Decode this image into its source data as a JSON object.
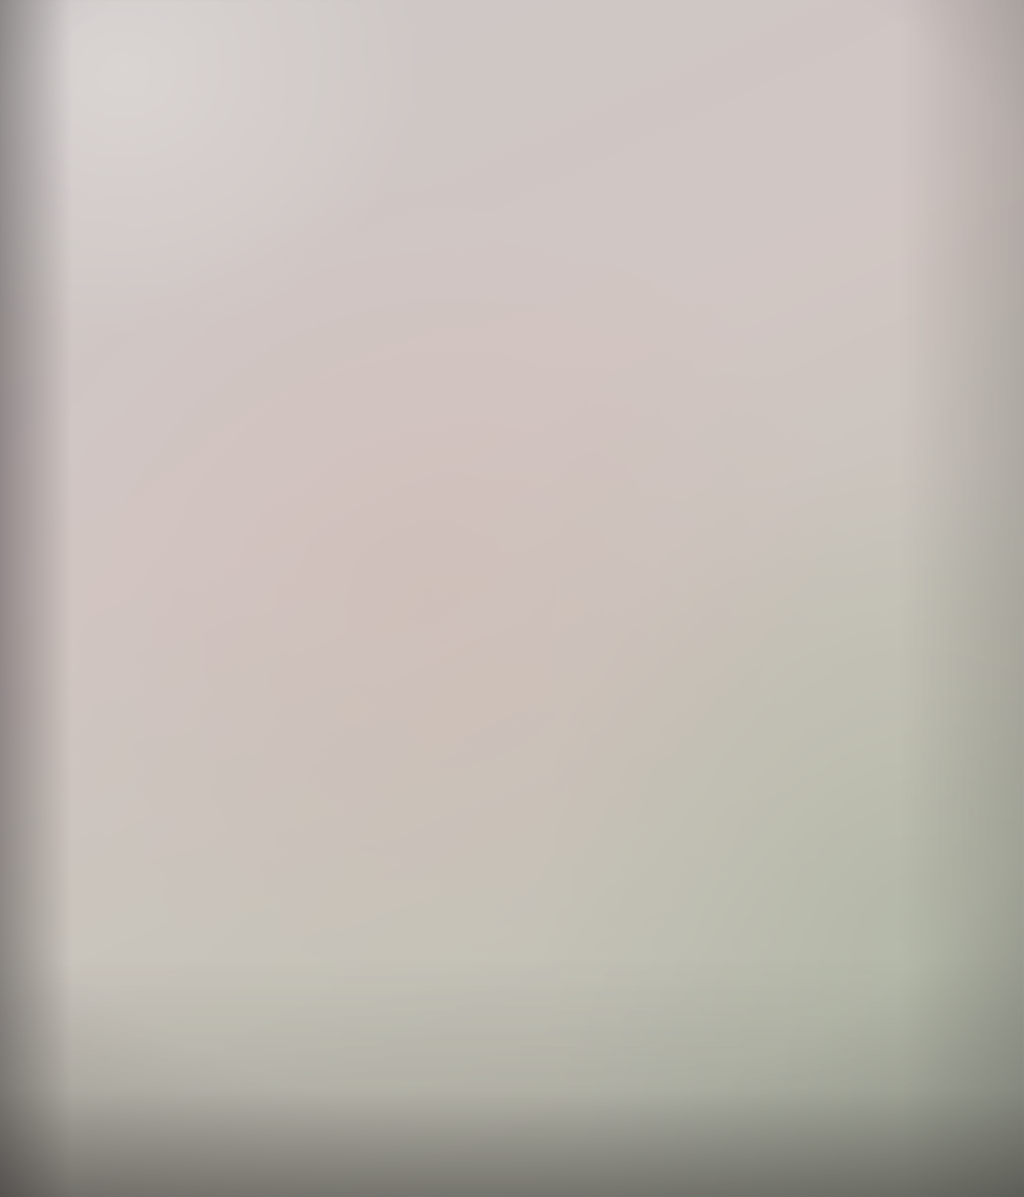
{
  "watermark": {
    "icon": "swan-swirl-icon",
    "name_cn": "锦明地产",
    "name_en": "Jinming Real Estate",
    "color": "#ffffff"
  },
  "branding": {
    "site_cn": "房天下",
    "site_en": "Fang.com",
    "color": "#ffffff"
  },
  "plan": {
    "ink_color": "#3a3336",
    "paper_color": "#cfc7c3",
    "units": [
      {
        "no": "15",
        "area": "114.82"
      },
      {
        "no": "12",
        "area": "104.13"
      },
      {
        "no": "16",
        "area": "121.42"
      },
      {
        "no": "11",
        "area": "126.08"
      },
      {
        "no": "10",
        "area": "144.86"
      },
      {
        "no": "09",
        "area": "107.98"
      },
      {
        "no": "08",
        "area": "107.07"
      },
      {
        "no": "17",
        "area": "276.52"
      },
      {
        "no": "18",
        "area": "132.98"
      },
      {
        "no": "07",
        "area": "119.19"
      },
      {
        "no": "01",
        "area": ""
      },
      {
        "no": "02",
        "area": ""
      },
      {
        "no": "03",
        "area": ""
      }
    ],
    "floor_areas_bottom": [
      "151.45",
      "102.49",
      "102.49",
      "102.47",
      "91.34"
    ]
  }
}
